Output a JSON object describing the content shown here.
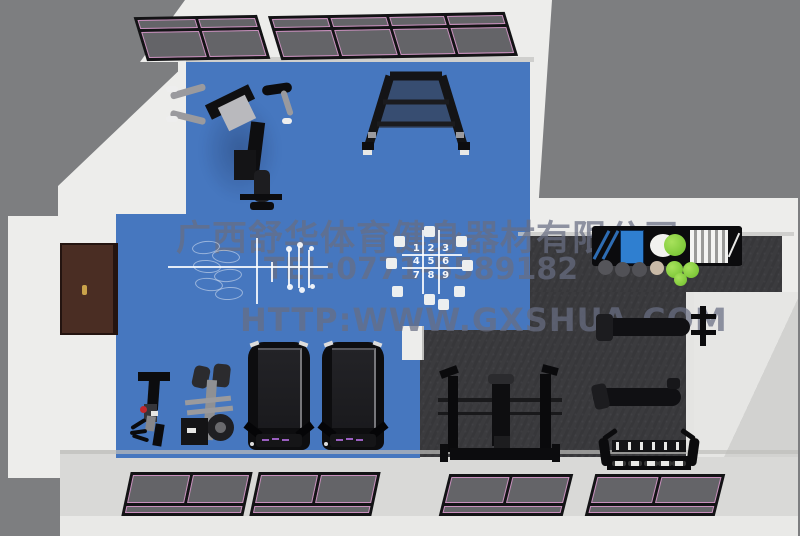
{
  "scene_name": "gym-equipment-floor-plan-3d-render",
  "colors": {
    "bg": "#7d7e80",
    "wall": "#ededeb",
    "wall-shade": "#c7c7c5",
    "floor-blue": "#4677bf",
    "floor-dark": "#3b3b3e",
    "floor-light": "#d9d9d7",
    "window-frame": "#131315",
    "window-pane": "#646468",
    "window-trim": "#c98fbd",
    "door": "#4a2d23",
    "door-handle": "#c9a24a",
    "equip-black": "#111113",
    "equip-gray": "#8f9093",
    "accent-red": "#c0272d",
    "accent-green": "#7fc93a",
    "accent-blue": "#2f7fd0",
    "console-purple": "#9a5fc0",
    "watermark-color": "rgba(104,110,130,0.72)"
  },
  "watermark": {
    "company": "广西舒华体育健身器材有限公司",
    "phone": "TEL:0771-5589182",
    "website": "HTTP:WWW.GXSHUA.COM"
  },
  "grid": {
    "digits": [
      "1",
      "2",
      "3",
      "4",
      "5",
      "6",
      "7",
      "8",
      "9"
    ]
  },
  "objects": [
    "multi-station-machine",
    "leg-press-rack",
    "cable-machine",
    "leg-curl-machine",
    "treadmill",
    "treadmill",
    "squat-rack",
    "flat-bench",
    "adjustable-bench",
    "dumbbell-rack",
    "reception-counter",
    "exercise-balls",
    "entry-door",
    "skylight-windows",
    "floor-number-grid",
    "floor-court-lines"
  ]
}
